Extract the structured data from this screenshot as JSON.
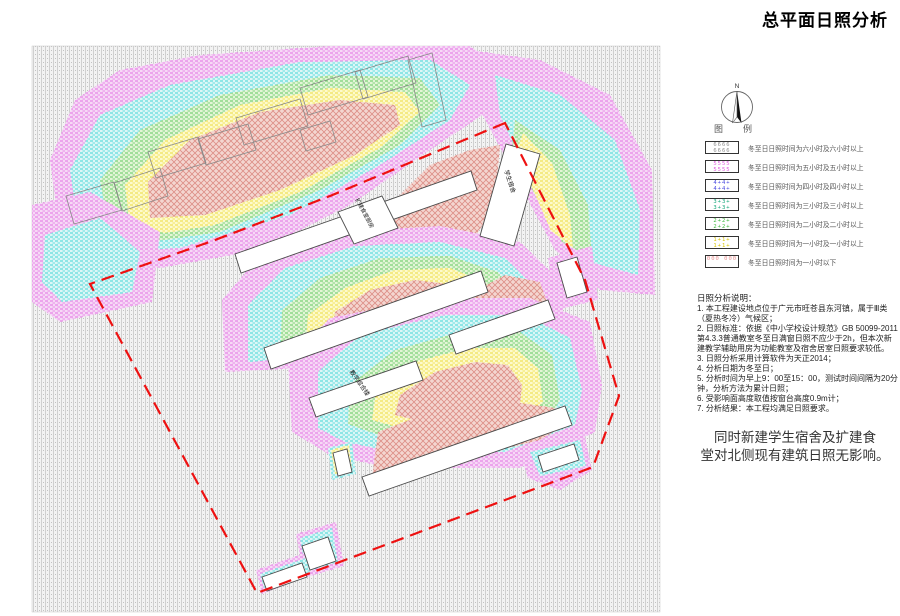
{
  "title": "总平面日照分析",
  "compass": {
    "north_label": "N"
  },
  "legend": {
    "caption_left": "图",
    "caption_right": "例",
    "items": [
      {
        "swatch": "6666 6666",
        "color": "#8f8f8f",
        "label": "冬至日日照时间为六小时及六小时以上"
      },
      {
        "swatch": "5555 5555",
        "color": "#e05ce0",
        "label": "冬至日日照时间为五小时及五小时以上"
      },
      {
        "swatch": "4+4+ 4+4+",
        "color": "#4a4ae0",
        "label": "冬至日日照时间为四小时及四小时以上"
      },
      {
        "swatch": "3+3+ 3+3+",
        "color": "#16a87a",
        "label": "冬至日日照时间为三小时及三小时以上"
      },
      {
        "swatch": "2+2+ 2+2+",
        "color": "#3cb83c",
        "label": "冬至日日照时间为二小时及二小时以上"
      },
      {
        "swatch": "1+1+ 1+1+",
        "color": "#d8c400",
        "label": "冬至日日照时间为一小时及一小时以上"
      },
      {
        "swatch": "000 000",
        "color": "#e89090",
        "label": "冬至日日照时间为一小时以下"
      }
    ]
  },
  "notes": {
    "title": "日照分析说明：",
    "items": [
      "1. 本工程建设地点位于广元市旺苍县东河镇，属于Ⅲ类（夏热冬冷）气候区；",
      "2. 日照标准：依据《中小学校设计规范》GB 50099-2011第4.3.3普通教室冬至日满窗日照不应少于2h，但本次新建教学辅助用房为功能教室及宿舍居室日照要求较低。",
      "3. 日照分析采用计算软件为天正2014；",
      "4. 分析日期为冬至日；",
      "5. 分析时间为早上9：00至15：00，测试时间间隔为20分钟，分析方法为累计日照；",
      "6. 受影响面高度取值按窗台高度0.9m计；",
      "7. 分析结果：本工程均满足日照要求。"
    ]
  },
  "statement": {
    "line1": "同时新建学生宿舍及扩建食",
    "line2": "堂对北侧现有建筑日照无影响。"
  },
  "map": {
    "labels": {
      "kitchen": "扩建食堂厨房",
      "dorm": "学生宿舍",
      "teaching": "教学综合楼"
    },
    "colors": {
      "boundary": "#ee1111",
      "zone_6h_plus": "#c8c8c8",
      "zone_5h": "#e878e8",
      "zone_4h": "#49d6d6",
      "zone_3h": "#66c966",
      "zone_2h": "#55bb55",
      "zone_1h": "#e8d83a",
      "zone_under_1h": "#dd8d85",
      "building_fill": "#ffffff"
    }
  }
}
